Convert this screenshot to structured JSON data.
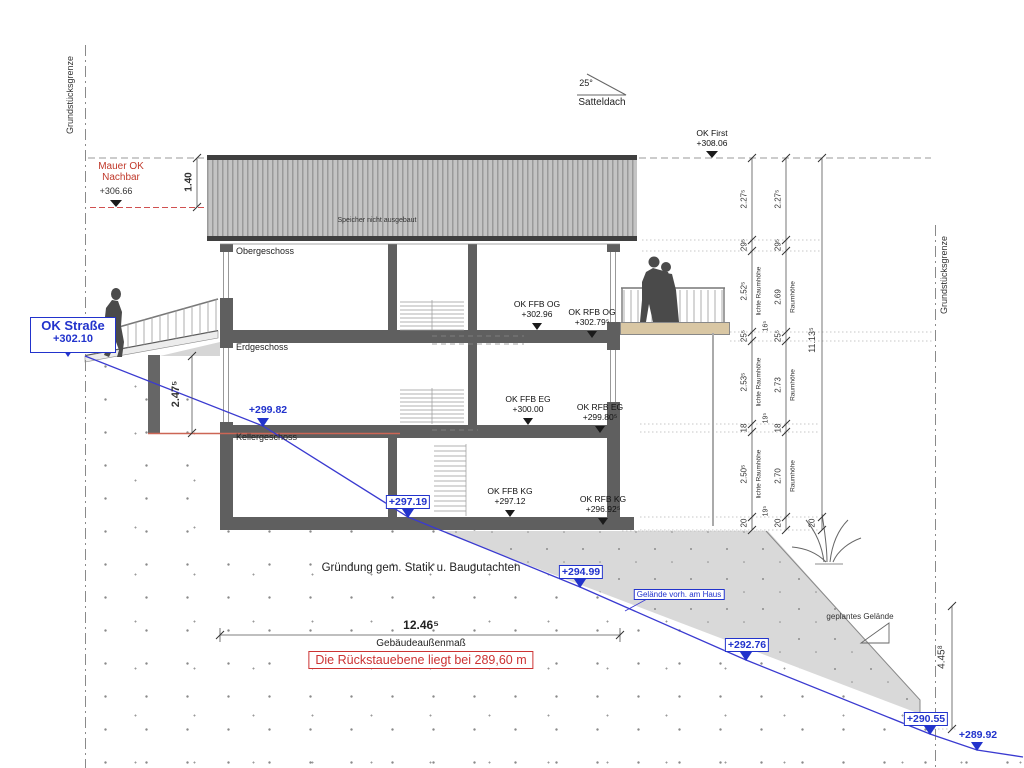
{
  "drawing": {
    "boundary_left": "Grundstücksgrenze",
    "boundary_right": "Grundstücksgrenze",
    "roof_pitch": "25°",
    "roof_type": "Satteldach",
    "attic_note": "Speicher nicht ausgebaut",
    "ok_first_label": "OK First",
    "ok_first_value": "+308.06",
    "neighbor_line1": "Mauer OK",
    "neighbor_line2": "Nachbar",
    "neighbor_value": "+306.66",
    "roof_height_dim": "1.40",
    "street_label": "OK Straße",
    "street_value": "+302.10",
    "floor_og": "Obergeschoss",
    "floor_eg": "Erdgeschoss",
    "floor_kg": "Kellergeschoss",
    "foundation_note": "Gründung gem. Statik u. Baugutachten",
    "backflow_note": "Die Rückstauebene liegt bei 289,60 m",
    "building_width_value": "12.46⁵",
    "building_width_label": "Gebäudeaußenmaß",
    "wall_height_dim": "2.47⁵",
    "slope_height_dim": "4.45⁸",
    "terrain_existing_label": "Gelände vorh. am Haus",
    "terrain_planned_label": "geplantes Gelände"
  },
  "levels": {
    "ffb_og_label": "OK FFB OG",
    "ffb_og_value": "+302.96",
    "rfb_og_label": "OK RFB OG",
    "rfb_og_value": "+302.79⁵",
    "ffb_eg_label": "OK FFB EG",
    "ffb_eg_value": "+300.00",
    "rfb_eg_label": "OK RFB EG",
    "rfb_eg_value": "+299.80⁵",
    "ffb_kg_label": "OK FFB KG",
    "ffb_kg_value": "+297.12",
    "rfb_kg_label": "OK RFB KG",
    "rfb_kg_value": "+296.92⁵"
  },
  "terrain_marks": {
    "m1": "+299.82",
    "m2": "+297.19",
    "m3": "+294.99",
    "m4": "+292.76",
    "m5": "+290.55",
    "m6": "+289.92"
  },
  "dim_chain_inner": {
    "s0": "2.27⁵",
    "s1": "29⁵",
    "s2": "2.52⁵",
    "s3": "25⁵",
    "s4": "2.53⁵",
    "s5": "18",
    "s6": "2.50⁵",
    "s7": "20",
    "room_label": "lichte Raumhöhe"
  },
  "dim_chain_outer": {
    "s0": "2.27⁵",
    "s1": "29⁵",
    "s2": "2.69",
    "s3": "25⁵",
    "s4": "2.73",
    "s5": "18",
    "s6": "2.70",
    "s7": "20",
    "room_label": "Raumhöhe"
  },
  "dim_chain_between": {
    "b0": "16⁵",
    "b1": "19⁵",
    "b2": "19⁵"
  },
  "dim_chain_total": {
    "total": "11.13⁵",
    "bottom": "20"
  },
  "colors": {
    "blue": "#2233cc",
    "red": "#c0392b",
    "wall": "#5f5f5f",
    "terrain": "#d9d9d9",
    "deck": "#d9c7a4"
  }
}
